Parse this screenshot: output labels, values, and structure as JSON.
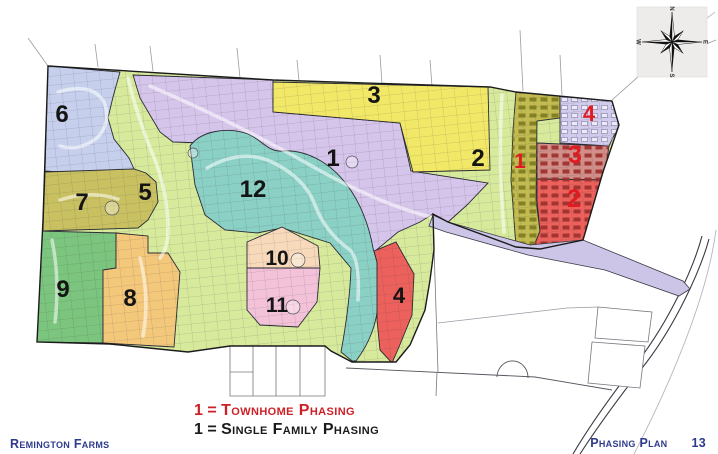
{
  "footer": {
    "left": "Remington Farms",
    "right": "Phasing Plan",
    "page_number": "13",
    "color": "#2e3a8d"
  },
  "legend": {
    "townhome": {
      "symbol": "1",
      "eq": "=",
      "label": "Townhome Phasing",
      "color": "#cc2127"
    },
    "single_family": {
      "symbol": "1",
      "eq": "=",
      "label": "Single Family Phasing",
      "color": "#1a1a1a"
    }
  },
  "compass": {
    "cx": 672,
    "cy": 42,
    "box": [
      637,
      7,
      70,
      70
    ],
    "directions": [
      "N",
      "E",
      "S",
      "W"
    ]
  },
  "map": {
    "base_fill": "#d7ea9c",
    "outline_color": "#1b1b1b",
    "site_outline": "M48,66 L273,80 L490,87 L516,92 L612,101 L619,125 L603,172 L583,240 L540,249 L516,247 L448,222 L433,214 L434,250 L430,280 L425,310 L410,345 L396,362 L352,362 L331,351 L325,346 L230,346 L188,352 L110,344 L37,342 L43,220 Z",
    "road": {
      "path": "M433,215 L448,222 L530,245 L583,240 L683,281 L690,289 L679,296 L605,270 L528,255 L446,232 L429,226 Z",
      "fill": "#ccc5e7",
      "stroke": "#3a3a44"
    },
    "regions": [
      {
        "id": "sf-6",
        "fill": "#c6d0ed",
        "path": "M48,66 L120,72 L113,97 L108,118 L114,139 L129,158 L134,169 L100,175 L45,171 Z"
      },
      {
        "id": "sf-1",
        "fill": "#d6c5ea",
        "path": "M133,75 L273,80 L273,112 L400,123 L411,171 L488,183 L467,205 L447,223 L433,214 L420,222 L398,232 L374,252 L352,232 L322,210 L290,188 L262,168 L235,150 L205,143 L173,142 L160,132 L150,115 L140,98 Z"
      },
      {
        "id": "sf-3",
        "fill": "#f2e867",
        "path": "M273,82 L488,87 L490,170 L413,172 L400,123 L273,112 Z"
      },
      {
        "id": "sf-12",
        "fill": "#8bd0c5",
        "path": "M190,146 C200,132 225,126 248,134 C262,140 268,152 282,151 C305,149 330,162 347,185 C360,202 369,225 373,248 L377,262 L378,300 C378,322 369,344 356,361 L352,361 L341,352 C346,325 350,295 351,268 L330,243 L282,228 L257,233 L225,230 L205,215 L195,185 Z"
      },
      {
        "id": "sf-7",
        "fill": "#c9c161",
        "path": "M45,172 L134,169 L146,173 L156,182 L158,202 L148,220 L138,228 L43,231 Z"
      },
      {
        "id": "sf-9",
        "fill": "#7cc57e",
        "path": "M40,231 L116,233 L116,268 L103,270 L103,343 L37,342 Z"
      },
      {
        "id": "sf-8",
        "fill": "#f4c87b",
        "path": "M116,233 L148,236 L148,253 L168,253 L180,272 L174,347 L103,343 L103,270 L116,268 Z"
      },
      {
        "id": "sf-10",
        "fill": "#f8dabb",
        "path": "M282,227 L318,246 L320,268 L247,268 L247,242 Z"
      },
      {
        "id": "sf-11",
        "fill": "#f3c2d8",
        "path": "M247,268 L320,268 L317,302 L298,327 L260,325 L247,310 Z"
      },
      {
        "id": "sf-4",
        "fill": "#ec615c",
        "path": "M374,251 L396,242 L414,274 L412,315 L399,347 L392,363 L380,350 L377,320 L377,262 Z"
      },
      {
        "id": "th-1",
        "fill": "#c2bb52",
        "path": "M516,92 L560,96 L560,118 L537,121 L536,200 L540,231 L534,246 L516,247 L511,180 L513,130 Z",
        "texture": "bldgO"
      },
      {
        "id": "th-4",
        "fill": "#d2cbec",
        "path": "M560,96 L612,101 L619,125 L609,146 L560,143 L560,118 Z",
        "texture": "bldgL"
      },
      {
        "id": "th-3",
        "fill": "#d28e88",
        "path": "M537,143 L609,146 L604,180 L537,179 Z",
        "texture": "bldgR"
      },
      {
        "id": "th-2",
        "fill": "#ec615c",
        "path": "M537,179 L604,180 L600,212 L583,240 L540,249 L534,246 L540,231 L537,200 Z",
        "texture": "bldgR"
      }
    ],
    "streets": [
      "M58,92 Q92,82 104,102 Q112,122 97,138 Q78,152 60,146",
      "M150,86 Q240,125 310,165 Q380,205 435,218",
      "M207,168 Q242,148 272,162 Q305,178 315,205 Q325,232 350,250 Q360,260 358,300",
      "M128,78 Q138,120 155,160 Q168,195 168,230 Q168,248 160,258",
      "M60,200 Q90,190 118,199",
      "M52,240 Q60,280 55,322",
      "M140,258 Q150,298 143,336",
      "M502,95 Q498,160 504,232"
    ],
    "culdesacs": [
      [
        298,
        260,
        7
      ],
      [
        293,
        307,
        7
      ],
      [
        112,
        208,
        7
      ],
      [
        193,
        153,
        5
      ],
      [
        352,
        162,
        6
      ]
    ],
    "context_lines": [
      {
        "d": "M48,66 L28,38",
        "c": "#9a9aa5",
        "w": 0.8
      },
      {
        "d": "M95,44 L98,67",
        "c": "#9a9aa5",
        "w": 0.8
      },
      {
        "d": "M150,46 L153,71",
        "c": "#9a9aa5",
        "w": 0.8
      },
      {
        "d": "M237,48 L240,78",
        "c": "#9a9aa5",
        "w": 0.8
      },
      {
        "d": "M297,60 L299,81",
        "c": "#9a9aa5",
        "w": 0.8
      },
      {
        "d": "M380,55 L382,84",
        "c": "#9a9aa5",
        "w": 0.8
      },
      {
        "d": "M430,60 L432,86",
        "c": "#9a9aa5",
        "w": 0.8
      },
      {
        "d": "M520,30 L523,91",
        "c": "#9a9aa5",
        "w": 0.8
      },
      {
        "d": "M560,55 L562,95",
        "c": "#9a9aa5",
        "w": 0.8
      },
      {
        "d": "M612,100 L648,68 L716,40",
        "c": "#9a9aa5",
        "w": 0.8
      },
      {
        "d": "M640,70 L715,12",
        "c": "#b9b9c0",
        "w": 0.8
      },
      {
        "d": "M702,236 C693,270 668,322 639,360 C617,388 593,420 573,454",
        "c": "#3a3a44",
        "w": 1.1
      },
      {
        "d": "M709,239 C700,272 675,325 646,363 C624,391 600,423 580,454",
        "c": "#3a3a44",
        "w": 1.1
      },
      {
        "d": "M716,230 C707,300 667,390 634,454",
        "c": "#b5b5bd",
        "w": 0.9
      },
      {
        "d": "M346,368 L535,377 L612,390",
        "c": "#55555e",
        "w": 0.9
      },
      {
        "d": "M497,377 A15,16 0 0 1 528,378",
        "c": "#55555e",
        "w": 0.9
      },
      {
        "d": "M437,372 L436,396",
        "c": "#77777f",
        "w": 0.8
      },
      {
        "d": "M433,216 L438,372",
        "c": "#77777f",
        "w": 0.8
      },
      {
        "d": "M438,323 L567,308 L598,307",
        "c": "#9a9aa5",
        "w": 0.8
      }
    ],
    "white_parcels": [
      "M230,346 L325,346 L325,396 L230,396 Z",
      "M253,346 L253,396",
      "M276,346 L276,396",
      "M300,346 L300,396",
      "M230,372 L253,372",
      "M276,333 L300,333 L300,346 L276,346 Z",
      "M598,307 L652,312 L648,342 L595,338 Z",
      "M592,342 L645,346 L640,388 L588,383 Z"
    ],
    "labels": [
      {
        "text": "6",
        "x": 62,
        "y": 122,
        "color": "#141414",
        "fs": 24
      },
      {
        "text": "5",
        "x": 145,
        "y": 200,
        "color": "#141414",
        "fs": 24
      },
      {
        "text": "7",
        "x": 82,
        "y": 210,
        "color": "#141414",
        "fs": 24
      },
      {
        "text": "9",
        "x": 63,
        "y": 297,
        "color": "#141414",
        "fs": 24
      },
      {
        "text": "8",
        "x": 130,
        "y": 306,
        "color": "#141414",
        "fs": 24
      },
      {
        "text": "12",
        "x": 253,
        "y": 197,
        "color": "#141414",
        "fs": 24
      },
      {
        "text": "10",
        "x": 277,
        "y": 265,
        "color": "#141414",
        "fs": 21
      },
      {
        "text": "11",
        "x": 277,
        "y": 312,
        "color": "#141414",
        "fs": 21
      },
      {
        "text": "1",
        "x": 333,
        "y": 166,
        "color": "#141414",
        "fs": 24
      },
      {
        "text": "3",
        "x": 374,
        "y": 103,
        "color": "#141414",
        "fs": 24
      },
      {
        "text": "2",
        "x": 478,
        "y": 166,
        "color": "#141414",
        "fs": 24
      },
      {
        "text": "4",
        "x": 399,
        "y": 303,
        "color": "#141414",
        "fs": 22
      },
      {
        "text": "1",
        "x": 520,
        "y": 168,
        "color": "#e11b22",
        "fs": 21
      },
      {
        "text": "4",
        "x": 589,
        "y": 121,
        "color": "#e11b22",
        "fs": 22
      },
      {
        "text": "3",
        "x": 575,
        "y": 163,
        "color": "#e11b22",
        "fs": 25
      },
      {
        "text": "2",
        "x": 574,
        "y": 207,
        "color": "#e11b22",
        "fs": 25
      }
    ]
  }
}
